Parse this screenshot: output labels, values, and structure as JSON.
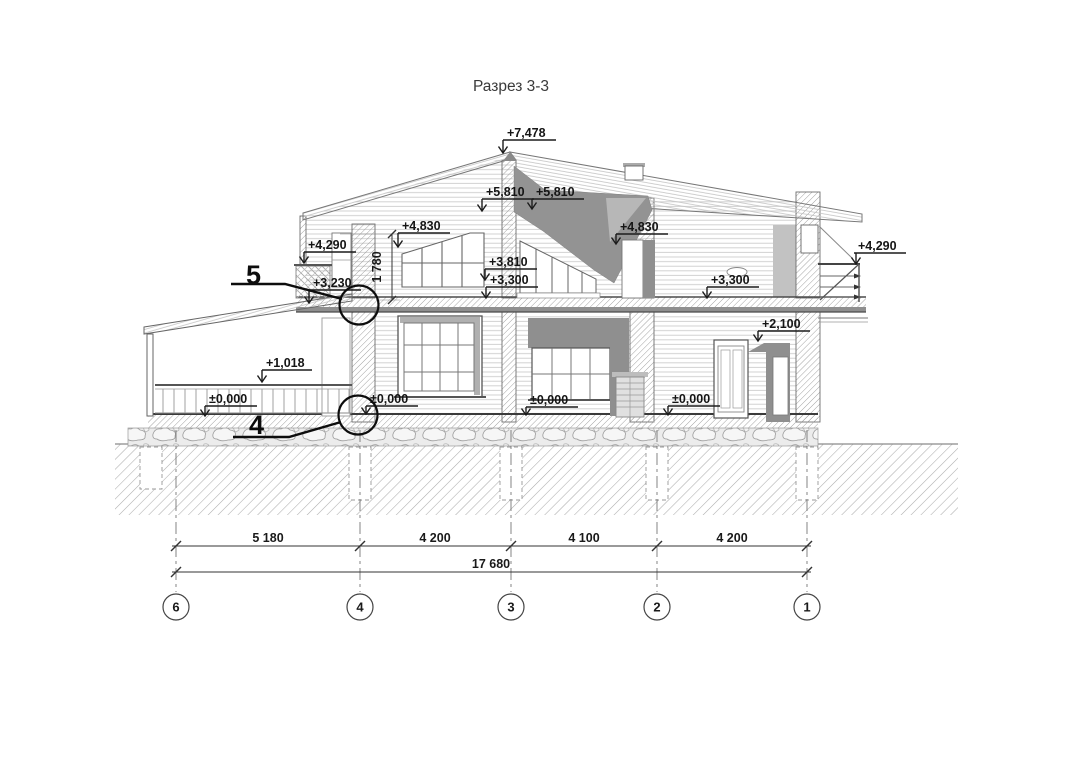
{
  "title": "Разрез 3-3",
  "elevations": {
    "ridge": "+7,478",
    "left_5810": "+5,810",
    "right_5810": "+5,810",
    "left_4830": "+4,830",
    "right_4830": "+4,830",
    "left_4290": "+4,290",
    "right_4290": "+4,290",
    "mid_3810": "+3,810",
    "left_3300": "+3,300",
    "right_3300": "+3,300",
    "left_3230": "+3,230",
    "right_2100": "+2,100",
    "porch_1018": "+1,018",
    "zero_porch": "±0,000",
    "zero_left": "±0,000",
    "zero_mid": "±0,000",
    "zero_right": "±0,000"
  },
  "vertical_dim": "1 780",
  "detail_callouts": {
    "upper": "5",
    "lower": "4"
  },
  "dimensions": {
    "seg_6_4": "5 180",
    "seg_4_3": "4 200",
    "seg_3_2": "4 100",
    "seg_2_1": "4 200",
    "total": "17 680"
  },
  "axes": {
    "a6": "6",
    "a4": "4",
    "a3": "3",
    "a2": "2",
    "a1": "1"
  }
}
